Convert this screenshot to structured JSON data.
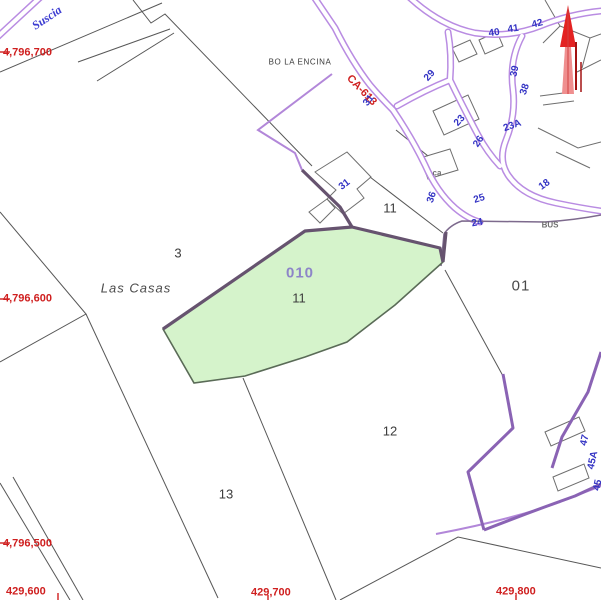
{
  "map": {
    "type": "cadastral-parcel-map",
    "selected_parcel": {
      "ref": "010",
      "subparcel": "11"
    },
    "colors": {
      "road_purple": "#b98ce2",
      "boundary_thin_purple": "#b287d9",
      "boundary_dark": "#66536f",
      "boundary_bright_purple": "#8a63b4",
      "parcel_line_gray": "#575757",
      "building_gray": "#6e6e6e",
      "selected_parcel_fill": "#d5f3cb",
      "selected_parcel_stroke": "#5a6b57",
      "coordinate_red": "#cf1f1f",
      "house_number_blue": "#3434c4",
      "parcel_ref_violet": "#8d85c8",
      "label_dark": "#3c3c3c",
      "north_arrow_red": "#e32222"
    },
    "labels": [
      {
        "name": "coordinate-label-y1",
        "cls": "coord",
        "text": "4,796,700",
        "x": 3,
        "y": 52,
        "rot": 0,
        "anchor": "start"
      },
      {
        "name": "coordinate-label-y2",
        "cls": "coord",
        "text": "4,796,600",
        "x": 3,
        "y": 298,
        "rot": 0,
        "anchor": "start"
      },
      {
        "name": "coordinate-label-y3",
        "cls": "coord",
        "text": "4,796,500",
        "x": 3,
        "y": 543,
        "rot": 0,
        "anchor": "start"
      },
      {
        "name": "coordinate-label-x1",
        "cls": "coord",
        "text": "429,600",
        "x": 6,
        "y": 591,
        "rot": 0,
        "anchor": "start"
      },
      {
        "name": "coordinate-label-x2",
        "cls": "coord",
        "text": "429,700",
        "x": 251,
        "y": 592,
        "rot": 0,
        "anchor": "start"
      },
      {
        "name": "coordinate-label-x3",
        "cls": "coord",
        "text": "429,800",
        "x": 496,
        "y": 591,
        "rot": 0,
        "anchor": "start"
      },
      {
        "name": "road-ref-label",
        "cls": "coord",
        "text": "CA-613",
        "x": 362,
        "y": 90,
        "rot": 46,
        "anchor": "middle"
      },
      {
        "name": "road-name-label",
        "cls": "roadname",
        "text": "Suscia",
        "x": 47,
        "y": 18,
        "rot": -34,
        "anchor": "middle"
      },
      {
        "name": "district-label",
        "cls": "place-sm",
        "text": "BO LA ENCINA",
        "x": 300,
        "y": 61,
        "rot": 0,
        "anchor": "middle"
      },
      {
        "name": "place-label",
        "cls": "place-it",
        "text": "Las Casas",
        "x": 136,
        "y": 289,
        "rot": 0,
        "anchor": "middle"
      },
      {
        "name": "selected-parcel-ref",
        "cls": "ref",
        "text": "010",
        "x": 300,
        "y": 274,
        "rot": 0,
        "anchor": "middle"
      },
      {
        "name": "parcel-number",
        "cls": "pnum",
        "text": "11",
        "x": 299,
        "y": 299,
        "rot": 0,
        "anchor": "middle"
      },
      {
        "name": "parcel-number",
        "cls": "pnum",
        "text": "3",
        "x": 178,
        "y": 254,
        "rot": 0,
        "anchor": "middle"
      },
      {
        "name": "parcel-number",
        "cls": "pnum",
        "text": "11",
        "x": 390,
        "y": 209,
        "rot": 0,
        "anchor": "middle"
      },
      {
        "name": "parcel-number",
        "cls": "pnum-lg",
        "text": "01",
        "x": 521,
        "y": 287,
        "rot": 0,
        "anchor": "middle"
      },
      {
        "name": "parcel-number",
        "cls": "pnum",
        "text": "12",
        "x": 390,
        "y": 432,
        "rot": 0,
        "anchor": "middle"
      },
      {
        "name": "parcel-number",
        "cls": "pnum",
        "text": "13",
        "x": 226,
        "y": 495,
        "rot": 0,
        "anchor": "middle"
      },
      {
        "name": "house-number",
        "cls": "hnum",
        "text": "40",
        "x": 494,
        "y": 32,
        "rot": -8,
        "anchor": "middle"
      },
      {
        "name": "house-number",
        "cls": "hnum",
        "text": "41",
        "x": 513,
        "y": 28,
        "rot": -8,
        "anchor": "middle"
      },
      {
        "name": "house-number",
        "cls": "hnum",
        "text": "42",
        "x": 537,
        "y": 23,
        "rot": -14,
        "anchor": "middle"
      },
      {
        "name": "house-number",
        "cls": "hnum",
        "text": "29",
        "x": 429,
        "y": 75,
        "rot": -48,
        "anchor": "middle"
      },
      {
        "name": "house-number",
        "cls": "hnum",
        "text": "39",
        "x": 514,
        "y": 71,
        "rot": -78,
        "anchor": "middle"
      },
      {
        "name": "house-number",
        "cls": "hnum",
        "text": "38",
        "x": 524,
        "y": 89,
        "rot": -72,
        "anchor": "middle"
      },
      {
        "name": "house-number",
        "cls": "hnum",
        "text": "23",
        "x": 459,
        "y": 120,
        "rot": -48,
        "anchor": "middle"
      },
      {
        "name": "house-number",
        "cls": "hnum",
        "text": "23A",
        "x": 512,
        "y": 125,
        "rot": -20,
        "anchor": "middle"
      },
      {
        "name": "house-number",
        "cls": "hnum",
        "text": "26",
        "x": 478,
        "y": 141,
        "rot": -56,
        "anchor": "middle"
      },
      {
        "name": "house-number",
        "cls": "hnum",
        "text": "31",
        "x": 368,
        "y": 100,
        "rot": -52,
        "anchor": "middle"
      },
      {
        "name": "house-number",
        "cls": "hnum",
        "text": "31",
        "x": 344,
        "y": 184,
        "rot": -38,
        "anchor": "middle"
      },
      {
        "name": "house-number",
        "cls": "hnum",
        "text": "36",
        "x": 431,
        "y": 197,
        "rot": -72,
        "anchor": "middle"
      },
      {
        "name": "house-number",
        "cls": "hnum",
        "text": "25",
        "x": 479,
        "y": 198,
        "rot": -18,
        "anchor": "middle"
      },
      {
        "name": "house-number",
        "cls": "hnum",
        "text": "24",
        "x": 477,
        "y": 222,
        "rot": -10,
        "anchor": "middle"
      },
      {
        "name": "house-number",
        "cls": "hnum",
        "text": "18",
        "x": 544,
        "y": 184,
        "rot": -36,
        "anchor": "middle"
      },
      {
        "name": "house-number",
        "cls": "hnum",
        "text": "47",
        "x": 584,
        "y": 440,
        "rot": -78,
        "anchor": "middle"
      },
      {
        "name": "house-number",
        "cls": "hnum",
        "text": "45A",
        "x": 592,
        "y": 460,
        "rot": -78,
        "anchor": "middle"
      },
      {
        "name": "house-number",
        "cls": "hnum",
        "text": "45",
        "x": 597,
        "y": 485,
        "rot": -78,
        "anchor": "middle"
      },
      {
        "name": "poi-label",
        "cls": "tiny",
        "text": "ca",
        "x": 437,
        "y": 172,
        "rot": 0,
        "anchor": "middle"
      },
      {
        "name": "bus-stop-label",
        "cls": "tiny",
        "text": "BUS",
        "x": 550,
        "y": 224,
        "rot": 0,
        "anchor": "middle"
      }
    ]
  }
}
